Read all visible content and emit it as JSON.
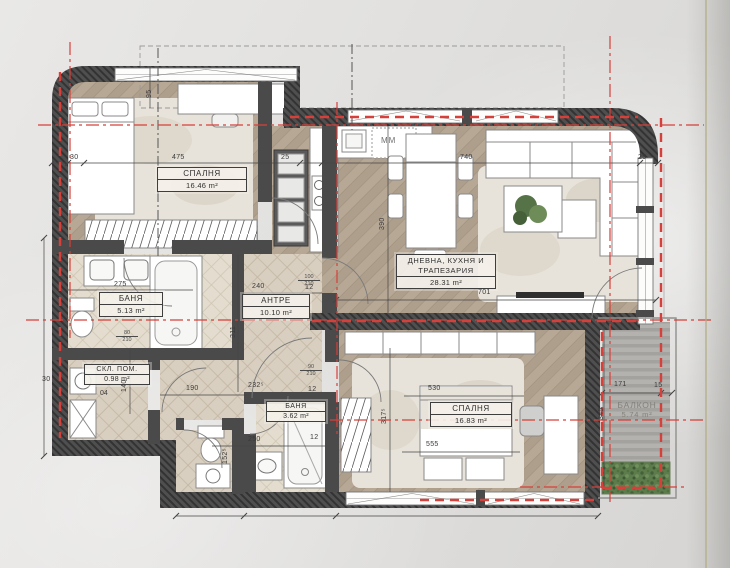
{
  "plan": {
    "rooms": {
      "bedroom1": {
        "name": "СПАЛНЯ",
        "area": "16.46 m²"
      },
      "living": {
        "name_line1": "ДНЕВНА, КУХНЯ И",
        "name_line2": "ТРАПЕЗАРИЯ",
        "area": "28.31 m²"
      },
      "bath1": {
        "name": "БАНЯ",
        "area": "5.13 m²"
      },
      "hall": {
        "name": "АНТРЕ",
        "area": "10.10 m²"
      },
      "storage": {
        "name": "СКЛ. ПОМ.",
        "area": "0.98 m²",
        "tag": "04"
      },
      "bath2": {
        "name": "БАНЯ",
        "area": "3.62 m²"
      },
      "bedroom2": {
        "name": "СПАЛНЯ",
        "area": "16.83 m²"
      },
      "balcony": {
        "name": "БАЛКОН",
        "area": "5.74 m²"
      }
    },
    "appliances": {
      "microwave": "MM"
    },
    "dimensions": {
      "left_wall": "30",
      "bedroom1_width": "475",
      "pier_a": "25",
      "living_width": "740",
      "pier_b": "25",
      "window_offset": "95",
      "kitchen_depth": "390",
      "living_span": "701",
      "hall_width": "240",
      "wall_12a": "12",
      "bath1_width": "275",
      "hall_depth": "311",
      "storage_depth": "140",
      "storage_width": "190",
      "hall_bottom": "232⁵",
      "bedroom2_depth": "317⁵",
      "bed_width": "530",
      "bed_width2": "555",
      "bath2_width": "250",
      "bath2_depth": "152⁵",
      "balcony_width": "171",
      "balcony_edge": "15",
      "balcony_depth": "345",
      "left_wall_b": "30",
      "wall_12b": "12",
      "wall_12c": "12"
    },
    "doors": {
      "bath1": {
        "w": "80",
        "h": "210"
      },
      "hall_living": {
        "w": "100",
        "h": "210"
      },
      "hall_bedroom2": {
        "w": "90",
        "h": "210"
      }
    },
    "colors": {
      "wall": "#4a4a4a",
      "axis_red": "#d6403a",
      "wood": "#b7a795",
      "tile": "#d9cfc0",
      "green": "#5d7c4c"
    }
  }
}
